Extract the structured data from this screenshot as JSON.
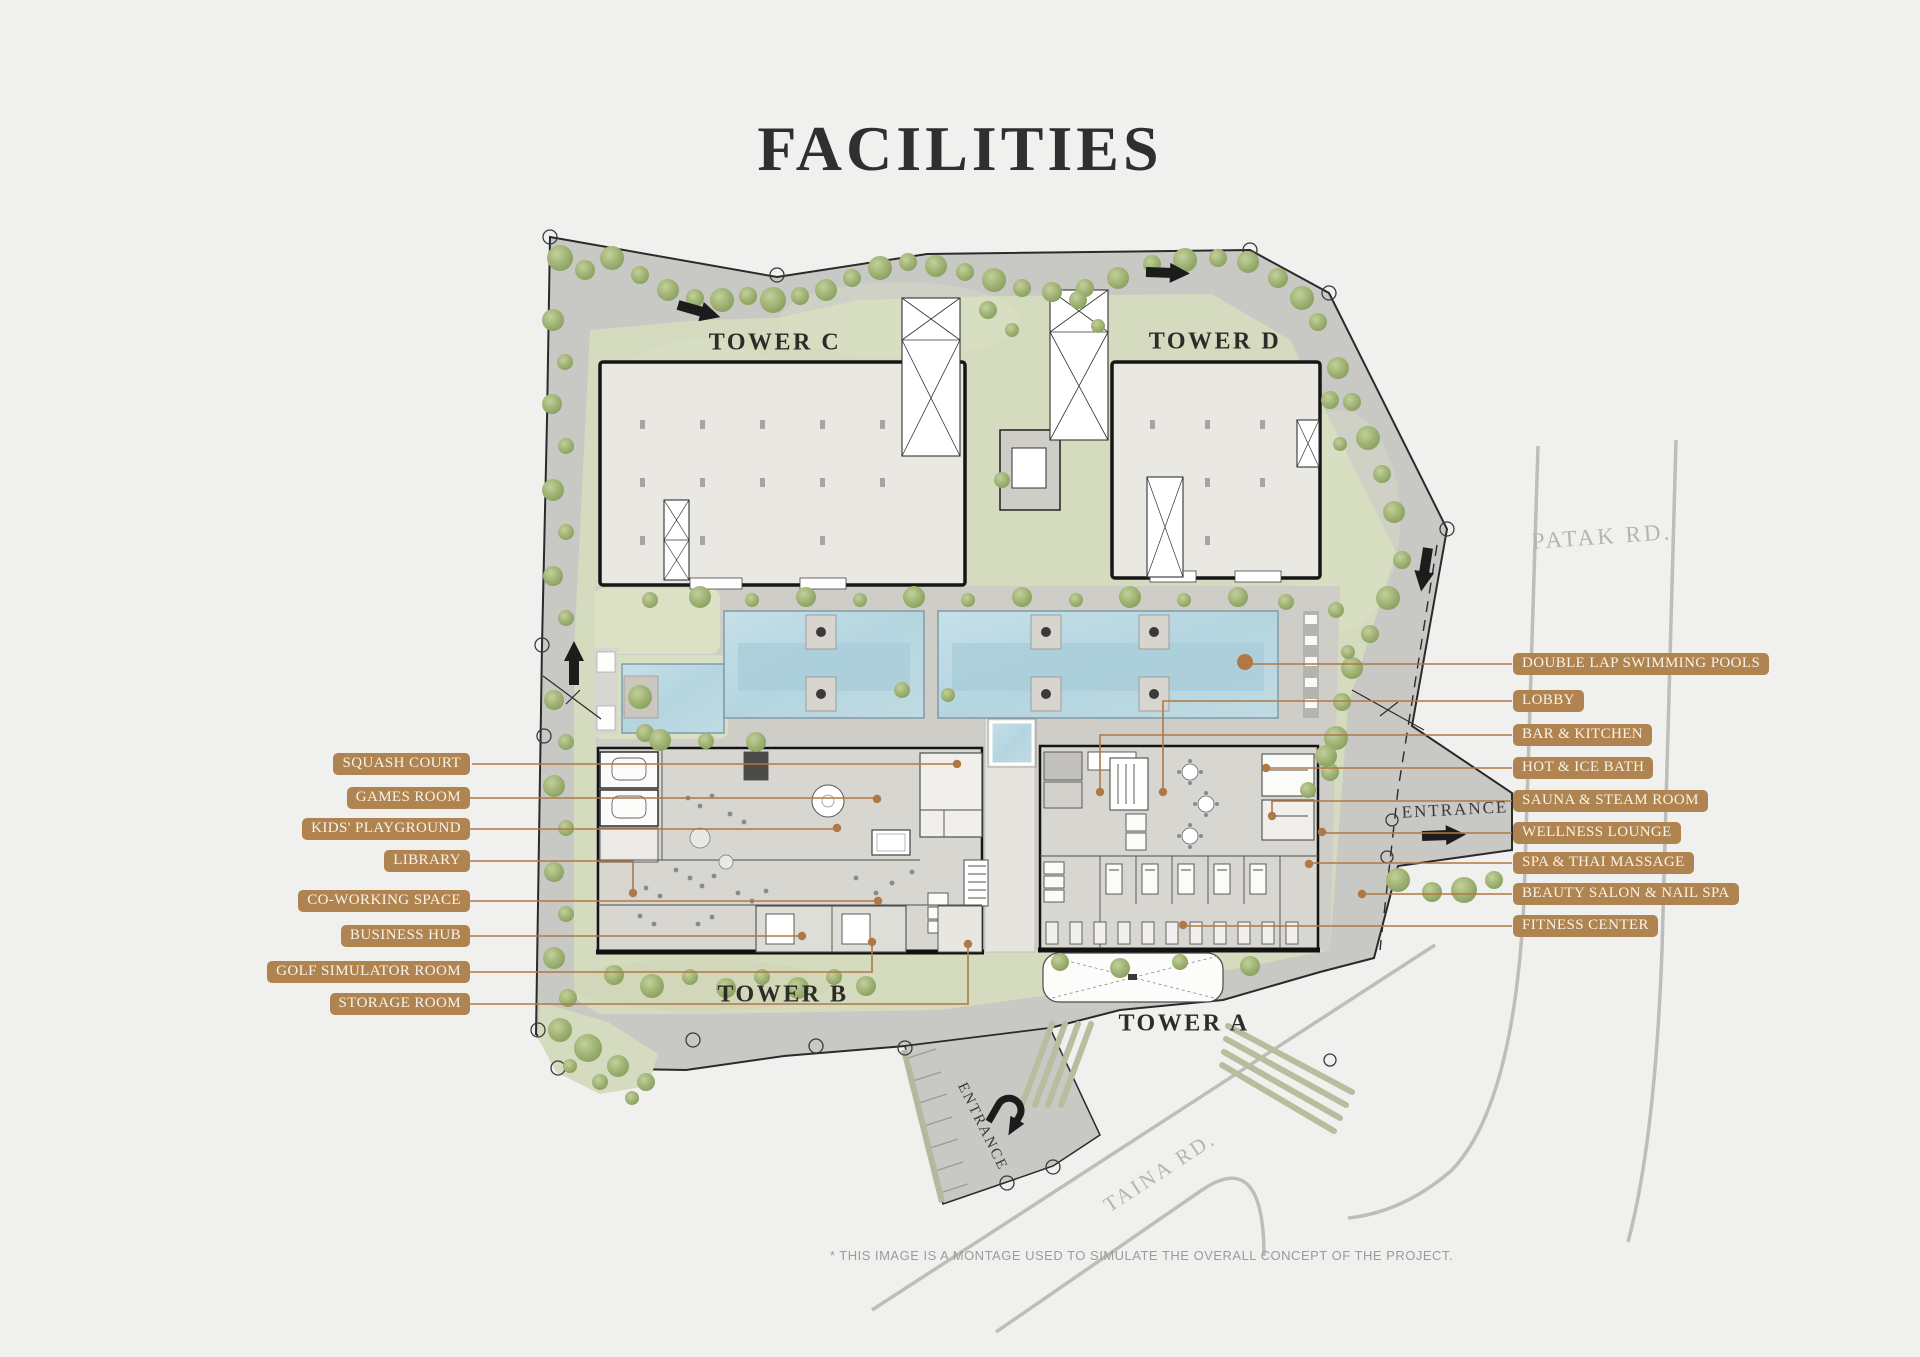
{
  "title": "FACILITIES",
  "towers": {
    "a": "TOWER A",
    "b": "TOWER B",
    "c": "TOWER C",
    "d": "TOWER D"
  },
  "roads": {
    "patak": "PATAK RD.",
    "taina": "TAINA RD."
  },
  "entrances": {
    "side": "ENTRANCE",
    "bottom": "ENTRANCE"
  },
  "labels": {
    "left": [
      {
        "text": "SQUASH COURT"
      },
      {
        "text": "GAMES ROOM"
      },
      {
        "text": "KIDS' PLAYGROUND"
      },
      {
        "text": "LIBRARY"
      },
      {
        "text": "CO-WORKING SPACE"
      },
      {
        "text": "BUSINESS HUB"
      },
      {
        "text": "GOLF SIMULATOR ROOM"
      },
      {
        "text": "STORAGE ROOM"
      }
    ],
    "right": [
      {
        "text": "DOUBLE LAP SWIMMING POOLS"
      },
      {
        "text": "LOBBY"
      },
      {
        "text": "BAR & KITCHEN"
      },
      {
        "text": "HOT & ICE BATH"
      },
      {
        "text": "SAUNA & STEAM ROOM"
      },
      {
        "text": "WELLNESS LOUNGE"
      },
      {
        "text": "SPA & THAI MASSAGE"
      },
      {
        "text": "BEAUTY SALON & NAIL SPA"
      },
      {
        "text": "FITNESS CENTER"
      }
    ]
  },
  "footnote": "* THIS IMAGE IS A MONTAGE USED TO SIMULATE THE OVERALL CONCEPT OF THE PROJECT.",
  "colors": {
    "page_bg": "#F0F0EE",
    "label_bg": "#B08450",
    "leader": "#B07845",
    "pool": "#BCD9E2",
    "green": "#D5DBBF",
    "road": "#C8C8C5",
    "deck": "#CFCDC7",
    "building": "#EAE8E3",
    "wing": "#D7D6D1",
    "title_text": "#2F2F31",
    "road_text": "#B4B4B2",
    "tower_text": "#2E2C29",
    "footnote_text": "#9B9B9B"
  }
}
